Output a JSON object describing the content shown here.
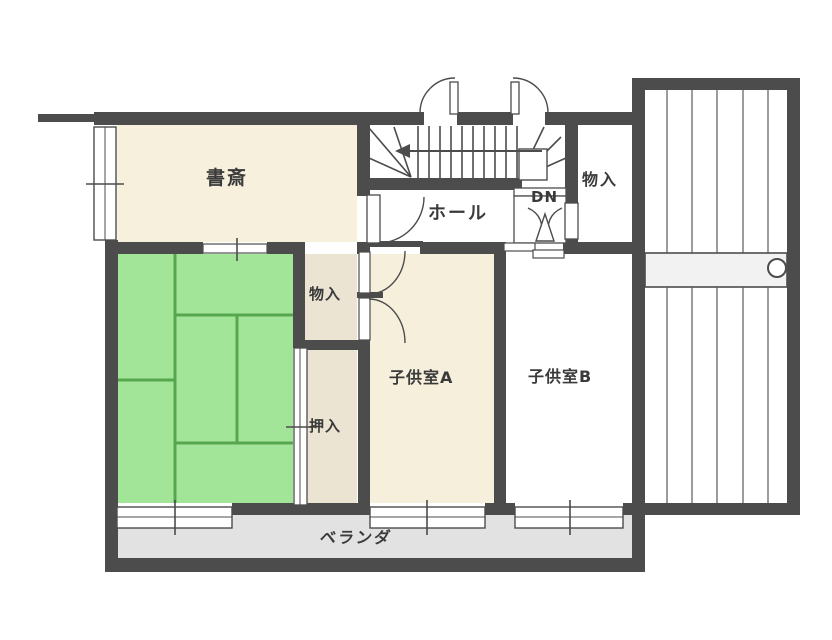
{
  "plan": {
    "type": "floor-plan",
    "floor_hint": "2F (stairs marked DN)",
    "rooms": [
      {
        "id": "study",
        "label": "書斎"
      },
      {
        "id": "hall",
        "label": "ホール"
      },
      {
        "id": "stairs-down",
        "label": "DN"
      },
      {
        "id": "storage-upper-right",
        "label": "物入"
      },
      {
        "id": "storage-middle",
        "label": "物入"
      },
      {
        "id": "closet-oshiire",
        "label": "押入"
      },
      {
        "id": "child-room-a",
        "label": "子供室A"
      },
      {
        "id": "child-room-b",
        "label": "子供室B"
      },
      {
        "id": "veranda",
        "label": "ベランダ"
      },
      {
        "id": "tatami-room",
        "label": ""
      }
    ],
    "colors": {
      "wall": "#4c4c4c",
      "study_floor": "#f7f0dd",
      "child_a_floor": "#f6efdc",
      "closet_floor": "#ebe4d3",
      "tatami_fill": "#a3e598",
      "tatami_line": "#55a64f",
      "child_b_floor": "#ffffff",
      "veranda_fill": "#e2e2e2",
      "balcony_band": "#f2f2f2",
      "background": "#ffffff",
      "text": "#3a3a3a"
    }
  }
}
